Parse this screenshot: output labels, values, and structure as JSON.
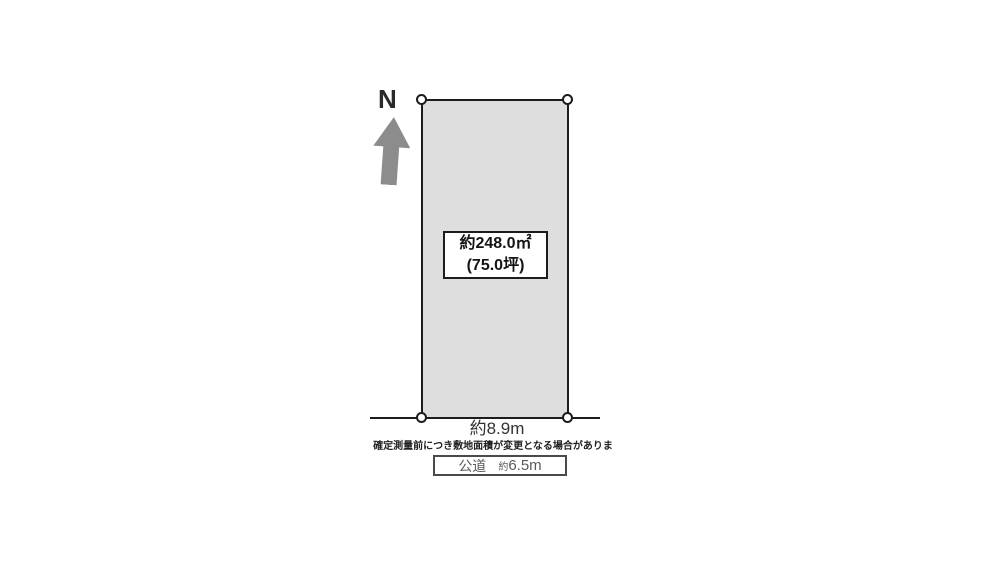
{
  "diagram": {
    "compass": {
      "label": "N"
    },
    "plot": {
      "area_box": {
        "line1": "約248.0㎡",
        "line2": "(75.0坪)"
      },
      "frontage_label": "約8.9m",
      "note": "確定測量前につき敷地面積が変更となる場合がありま",
      "road_box": {
        "name": "公道",
        "width_prefix": "約",
        "width_value": "6.5m"
      }
    },
    "colors": {
      "background": "#ffffff",
      "plot_fill": "#dedede",
      "outline": "#1c1c1c",
      "arrow_gray": "#8c8c8c",
      "road_text_gray": "#5a5a5a"
    }
  }
}
